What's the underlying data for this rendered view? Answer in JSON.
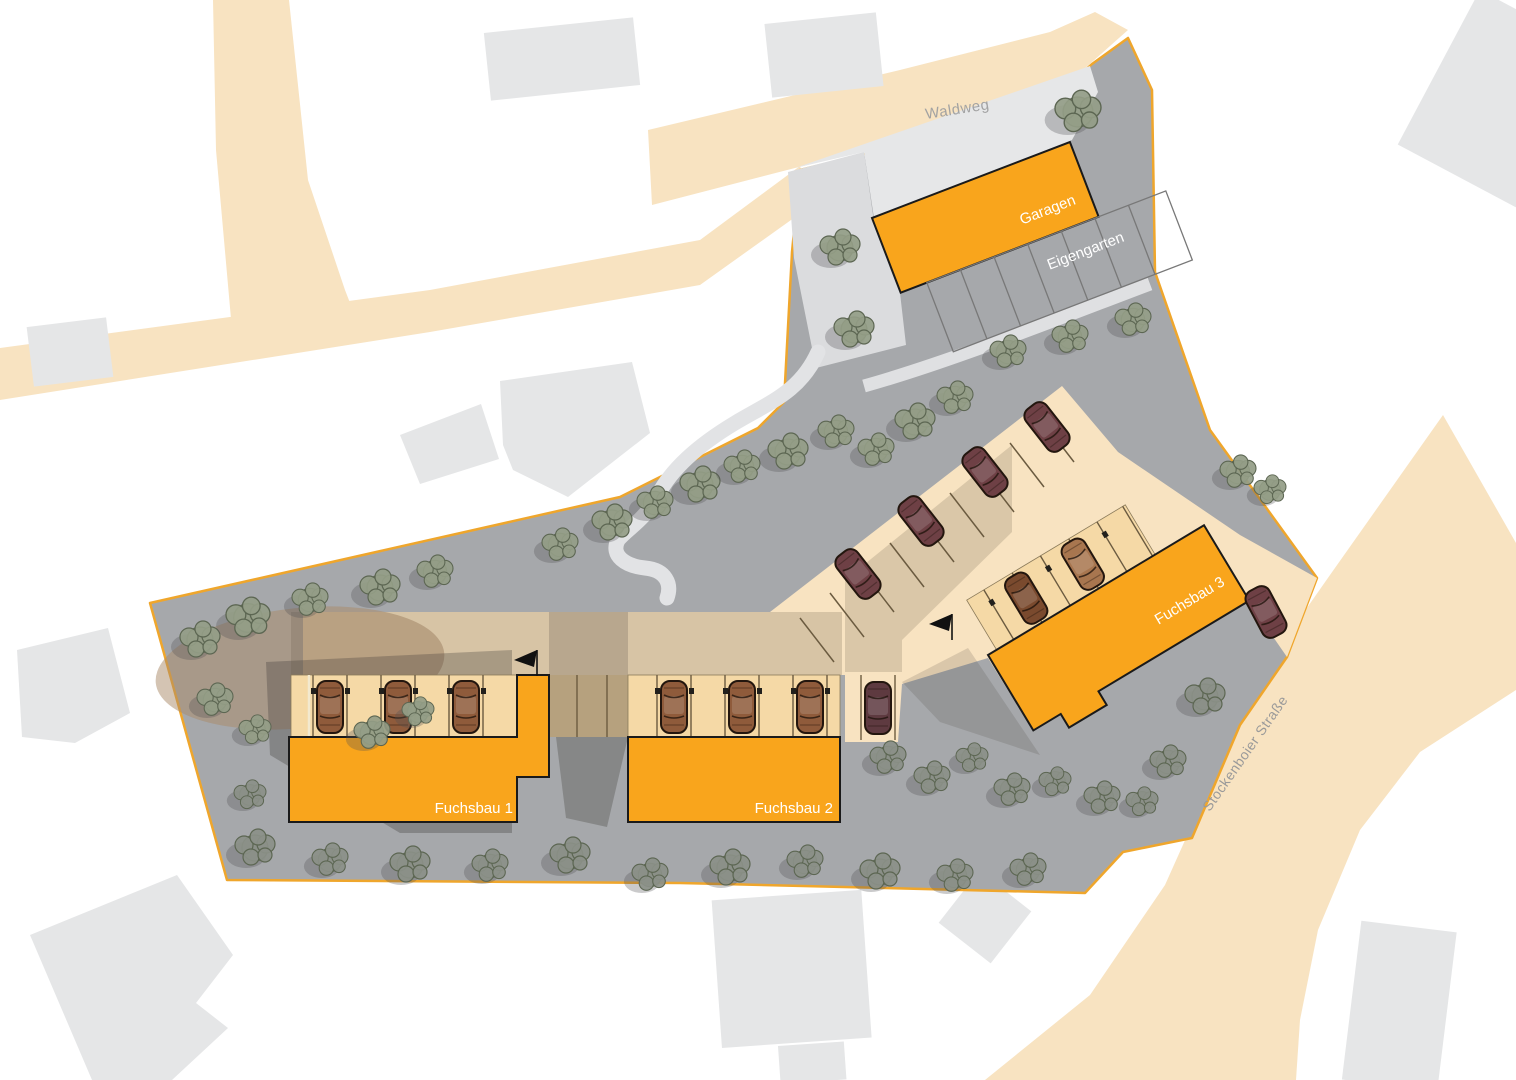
{
  "map": {
    "road_labels": {
      "top": "Waldweg",
      "right": "Stockenboier Straße"
    },
    "buildings": {
      "garage": {
        "label": "Garagen"
      },
      "garden": {
        "label": "Eigengarten"
      },
      "fuchsbau1": {
        "label": "Fuchsbau 1"
      },
      "fuchsbau2": {
        "label": "Fuchsbau 2"
      },
      "fuchsbau3": {
        "label": "Fuchsbau 3"
      }
    },
    "colors": {
      "road": "#F8E3C1",
      "site": "#A6A8AB",
      "boundary": "#EFA62C",
      "building_orange": "#F9A51C",
      "parking_strip": "#F5D9A6",
      "context_building": "#E5E6E7",
      "path": "#D9DADC",
      "tree_green": "#949D87",
      "tree_gray": "#8B9088",
      "car_brown": "#8F5B3B",
      "car_maroon": "#6E4045",
      "car_tan": "#A8764F",
      "road_label_text": "#A2A2A2",
      "building_label_text": "#FFFFFF"
    }
  }
}
